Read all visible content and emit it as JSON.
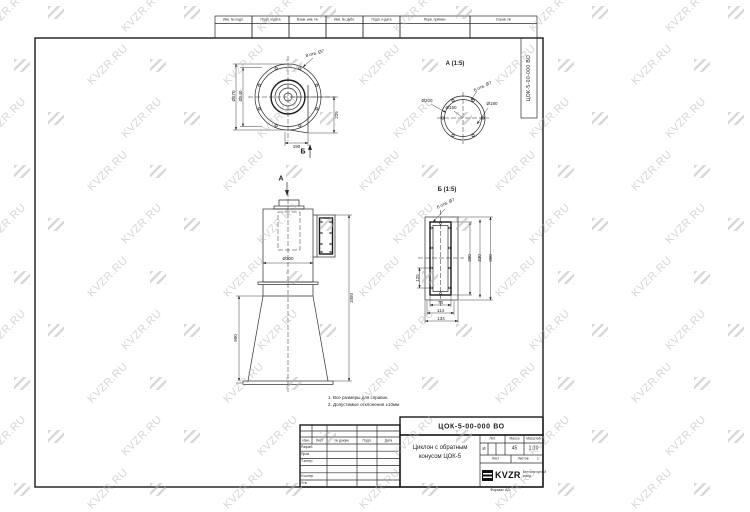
{
  "watermark": {
    "text": "KVZR.RU"
  },
  "top_strip": {
    "cells": [
      "Инв. № подл.",
      "Подп. и дата",
      "Взам. инв. №",
      "Инв. № дубл.",
      "Подп. и дата"
    ],
    "wide_cells": [
      "Перв. примен.",
      "Справ. №"
    ]
  },
  "side_stamp": {
    "doc_number": "ЦОК-5-00-000 ВО"
  },
  "views": {
    "top_view": {
      "label_a": "А",
      "label_b": "Б",
      "dims": {
        "d_outer": "Ø570",
        "d_inner": "Ø540",
        "right": "225",
        "bottom": "190",
        "holes_note": "8 отв. Ø7"
      }
    },
    "front_view": {
      "dims": {
        "diameter": "Ø300",
        "cone_height": "900",
        "total_height": "1050"
      }
    },
    "view_a": {
      "title": "А (1:5)",
      "dims": {
        "d1": "Ø200",
        "d2": "Ø150",
        "d3": "Ø180",
        "holes_note": "6 отв. Ø7"
      }
    },
    "view_b": {
      "title": "Б (1:5)",
      "dims": {
        "holes_note": "8 отв. Ø7",
        "h_inner": "300",
        "h_mid": "330",
        "h_outer": "350",
        "left": "125",
        "w_inner": "70",
        "w_mid": "114",
        "w_outer": "134"
      }
    }
  },
  "notes": {
    "line1": "1.  Все размеры для справок.",
    "line2": "2.  Допустимые отклонения ±10мм"
  },
  "title_block": {
    "doc_number": "ЦОК-5-00-000 ВО",
    "name": "Циклон с обратным конусом ЦОК-5",
    "columns": [
      "Изм.",
      "Лист",
      "№ докум.",
      "Подп.",
      "Дата"
    ],
    "rows": [
      "Разраб.",
      "Пров.",
      "Т.контр.",
      "",
      "Н.контр.",
      "Утв."
    ],
    "lit_label": "Лит.",
    "lit_value": "И",
    "mass_label": "Масса",
    "mass_value": "45",
    "scale_label": "Масштаб",
    "scale_value": "1:10",
    "sheet_label": "Лист",
    "sheets_label": "Листов",
    "sheets_value": "1",
    "logo_text": "KVZR",
    "logo_sub": "Вентиляторный завод",
    "format_label": "Формат А3"
  }
}
